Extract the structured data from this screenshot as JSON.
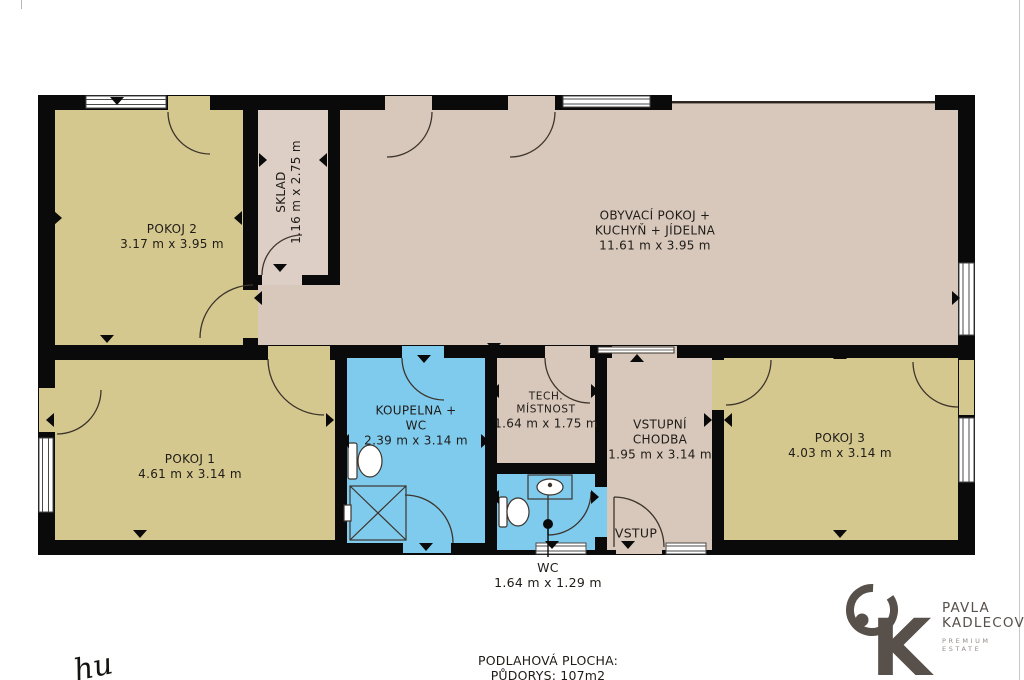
{
  "plan": {
    "rooms": {
      "pokoj2": {
        "name": "POKOJ 2",
        "dims": "3.17 m x 3.95 m"
      },
      "sklad": {
        "name": "SKLAD",
        "dims": "1.16 m x 2.75 m"
      },
      "obyvaci": {
        "name": "OBYVACÍ POKOJ +",
        "name2": "KUCHYŇ + JÍDELNA",
        "dims": "11.61 m x 3.95 m"
      },
      "pokoj1": {
        "name": "POKOJ 1",
        "dims": "4.61 m x 3.14 m"
      },
      "koupelna": {
        "name": "KOUPELNA +",
        "name2": "WC",
        "dims": "2.39 m x 3.14 m"
      },
      "tech": {
        "name": "TECH.",
        "name2": "MÍSTNOST",
        "dims": "1.64 m x 1.75 m"
      },
      "chodba": {
        "name": "VSTUPNÍ",
        "name2": "CHODBA",
        "dims": "1.95 m x 3.14 m"
      },
      "pokoj3": {
        "name": "POKOJ 3",
        "dims": "4.03 m x 3.14 m"
      },
      "wc": {
        "name": "WC",
        "dims": "1.64 m x 1.29 m"
      }
    },
    "labels": {
      "entrance": "VSTUP"
    },
    "colors": {
      "wall": "#0a0a0a",
      "room_beige": "#d5c88f",
      "room_tan": "#d8c8bb",
      "room_sklad": "#ddcfc5",
      "room_blue": "#7fcbee",
      "line": "#3d342c"
    }
  },
  "footer": {
    "area_label": "PODLAHOVÁ PLOCHA:",
    "area_value": "PŮDORYS: 107m2"
  },
  "branding": {
    "name_line1": "PAVLA",
    "name_line2": "KADLECOVÁ",
    "tagline": "PREMIUM ESTATE",
    "monogram": "K",
    "logo_color": "#57504b"
  },
  "signature": "hu"
}
